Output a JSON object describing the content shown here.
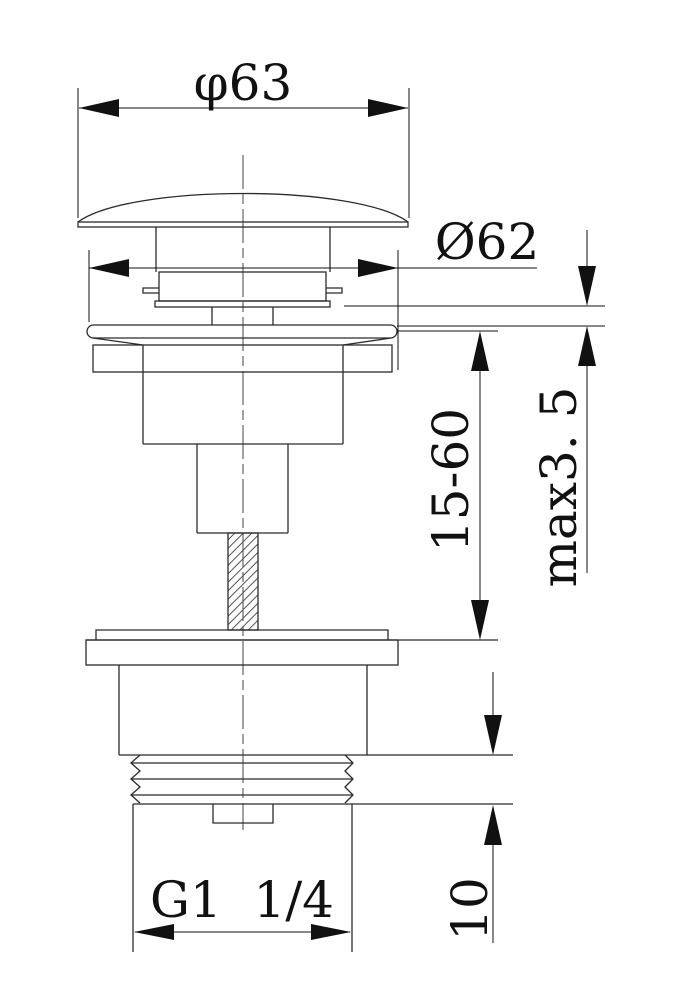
{
  "labels": {
    "cap_diameter": "φ63",
    "body_diameter": "Ø62",
    "height_range": "15-60",
    "max_thickness": "max3. 5",
    "thread_length": "10",
    "thread_spec": "G1  1/4"
  }
}
